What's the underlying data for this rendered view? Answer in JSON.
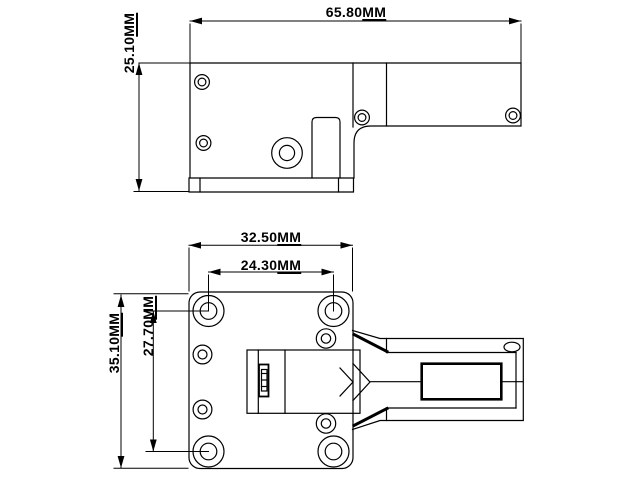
{
  "drawing": {
    "background_color": "#ffffff",
    "line_color": "#000000",
    "dimensions": {
      "overall_length": {
        "value": "65.80",
        "unit": "MM"
      },
      "overall_height": {
        "value": "25.10",
        "unit": "MM"
      },
      "mount_plate_width": {
        "value": "32.50",
        "unit": "MM"
      },
      "hole_spacing_horizontal": {
        "value": "24.30",
        "unit": "MM"
      },
      "hole_spacing_vertical": {
        "value": "27.70",
        "unit": "MM"
      },
      "mount_plate_height": {
        "value": "35.10",
        "unit": "MM"
      }
    }
  }
}
